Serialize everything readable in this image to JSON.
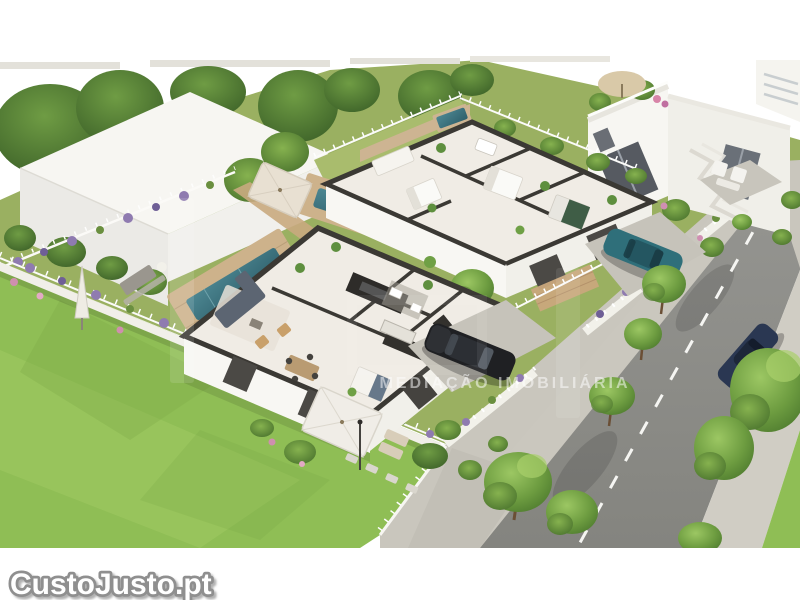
{
  "image": {
    "kind": "3D aerial architectural render",
    "subject": "New single-storey houses shown with cut-away floor plans, gardens, pools, perimeter walls with lavender, and a street with parked and passing cars"
  },
  "watermarks": {
    "brand_logo": "CustoJusto.pt",
    "center_line": "MEDIAÇÃO IMOBILIÁRIA"
  },
  "palette": {
    "background": "#ffffff",
    "lawn": "#8fbe55",
    "garden": "#9ab061",
    "road": "#8f8f8c",
    "sidewalk": "#cac7be",
    "wall_white": "#f6f5f1",
    "cut_wall_top": "#3b3934",
    "floor": "#f0ece5",
    "deck_wood": "#c9a87c",
    "pool_water": "#3a707c",
    "lavender": "#8f7bb0",
    "tree_green": "#5f8d39",
    "car_black": "#1f2023",
    "car_teal": "#2f6f7a",
    "car_navy": "#2a3752",
    "watermark_text": "#ffffff",
    "brand_fill": "#ffffff",
    "brand_outline": "#8f8f8f"
  },
  "scene": {
    "cutaway_houses": 2,
    "two_storey_houses": 1,
    "cars": [
      "black",
      "teal",
      "navy-blue"
    ],
    "road_marking": "dashed center line"
  }
}
